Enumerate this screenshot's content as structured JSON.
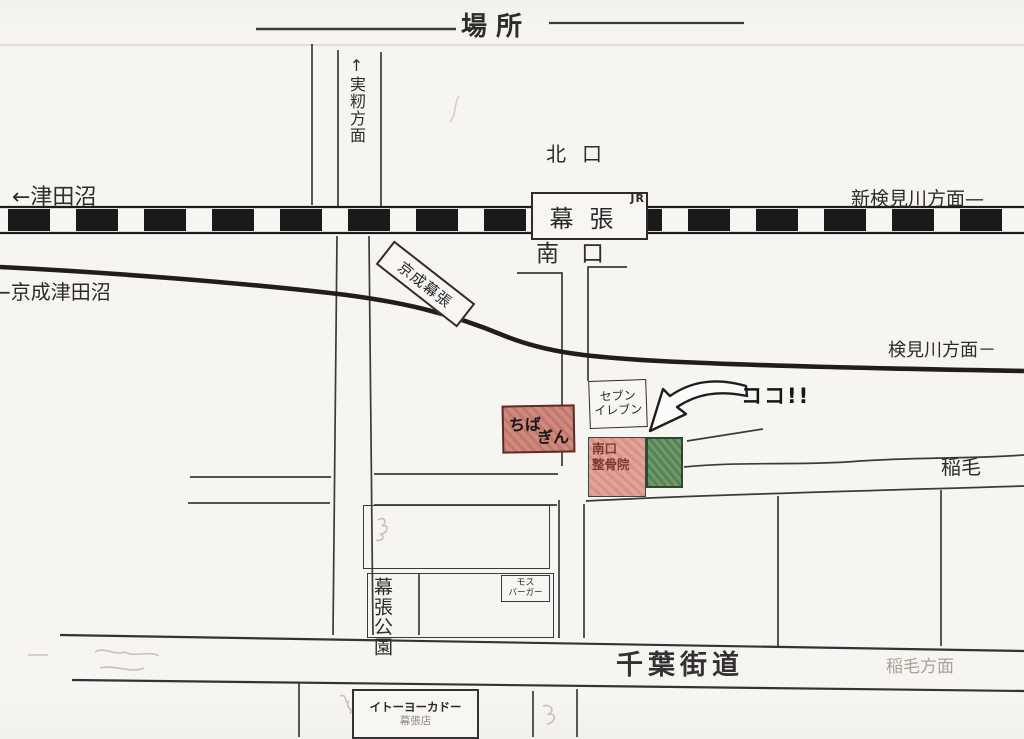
{
  "page": {
    "paper_color": "#f7f5f1",
    "ink_color": "#2a2a2a"
  },
  "title": "場所",
  "north_of_tracks": {
    "mimomi_road_label": "↑実籾方面",
    "north_exit_label": "北口"
  },
  "jr_line": {
    "to_left": "←津田沼",
    "to_right": "新検見川方面—",
    "station_name": "幕張",
    "operator": "JR",
    "south_exit_label": "南口"
  },
  "keisei_line": {
    "to_left": "←京成津田沼",
    "station_name": "京成幕張",
    "to_right": "検見川方面－"
  },
  "landmarks": {
    "seven_eleven": {
      "line1": "セブン",
      "line2": "イレブン"
    },
    "chiba_bank": {
      "line1": "ちば",
      "line2": "ぎん",
      "fill": "#cf8a80"
    },
    "clinic": {
      "line1": "南口",
      "line2": "整骨院",
      "fill": "#e2a399",
      "text_color": "#7b3a30"
    },
    "destination": {
      "marker_text": "ココ!!",
      "fill": "#6f9a6b"
    },
    "mos_burger": {
      "line1": "モス",
      "line2": "バーガー"
    },
    "park": "幕張公園",
    "ito_yokado": {
      "line1": "イトーヨーカドー",
      "line2": "幕張店"
    }
  },
  "south_roads": {
    "inage": "稲毛",
    "chiba_kaido": "千葉街道",
    "inage_homen": "稲毛方面"
  }
}
